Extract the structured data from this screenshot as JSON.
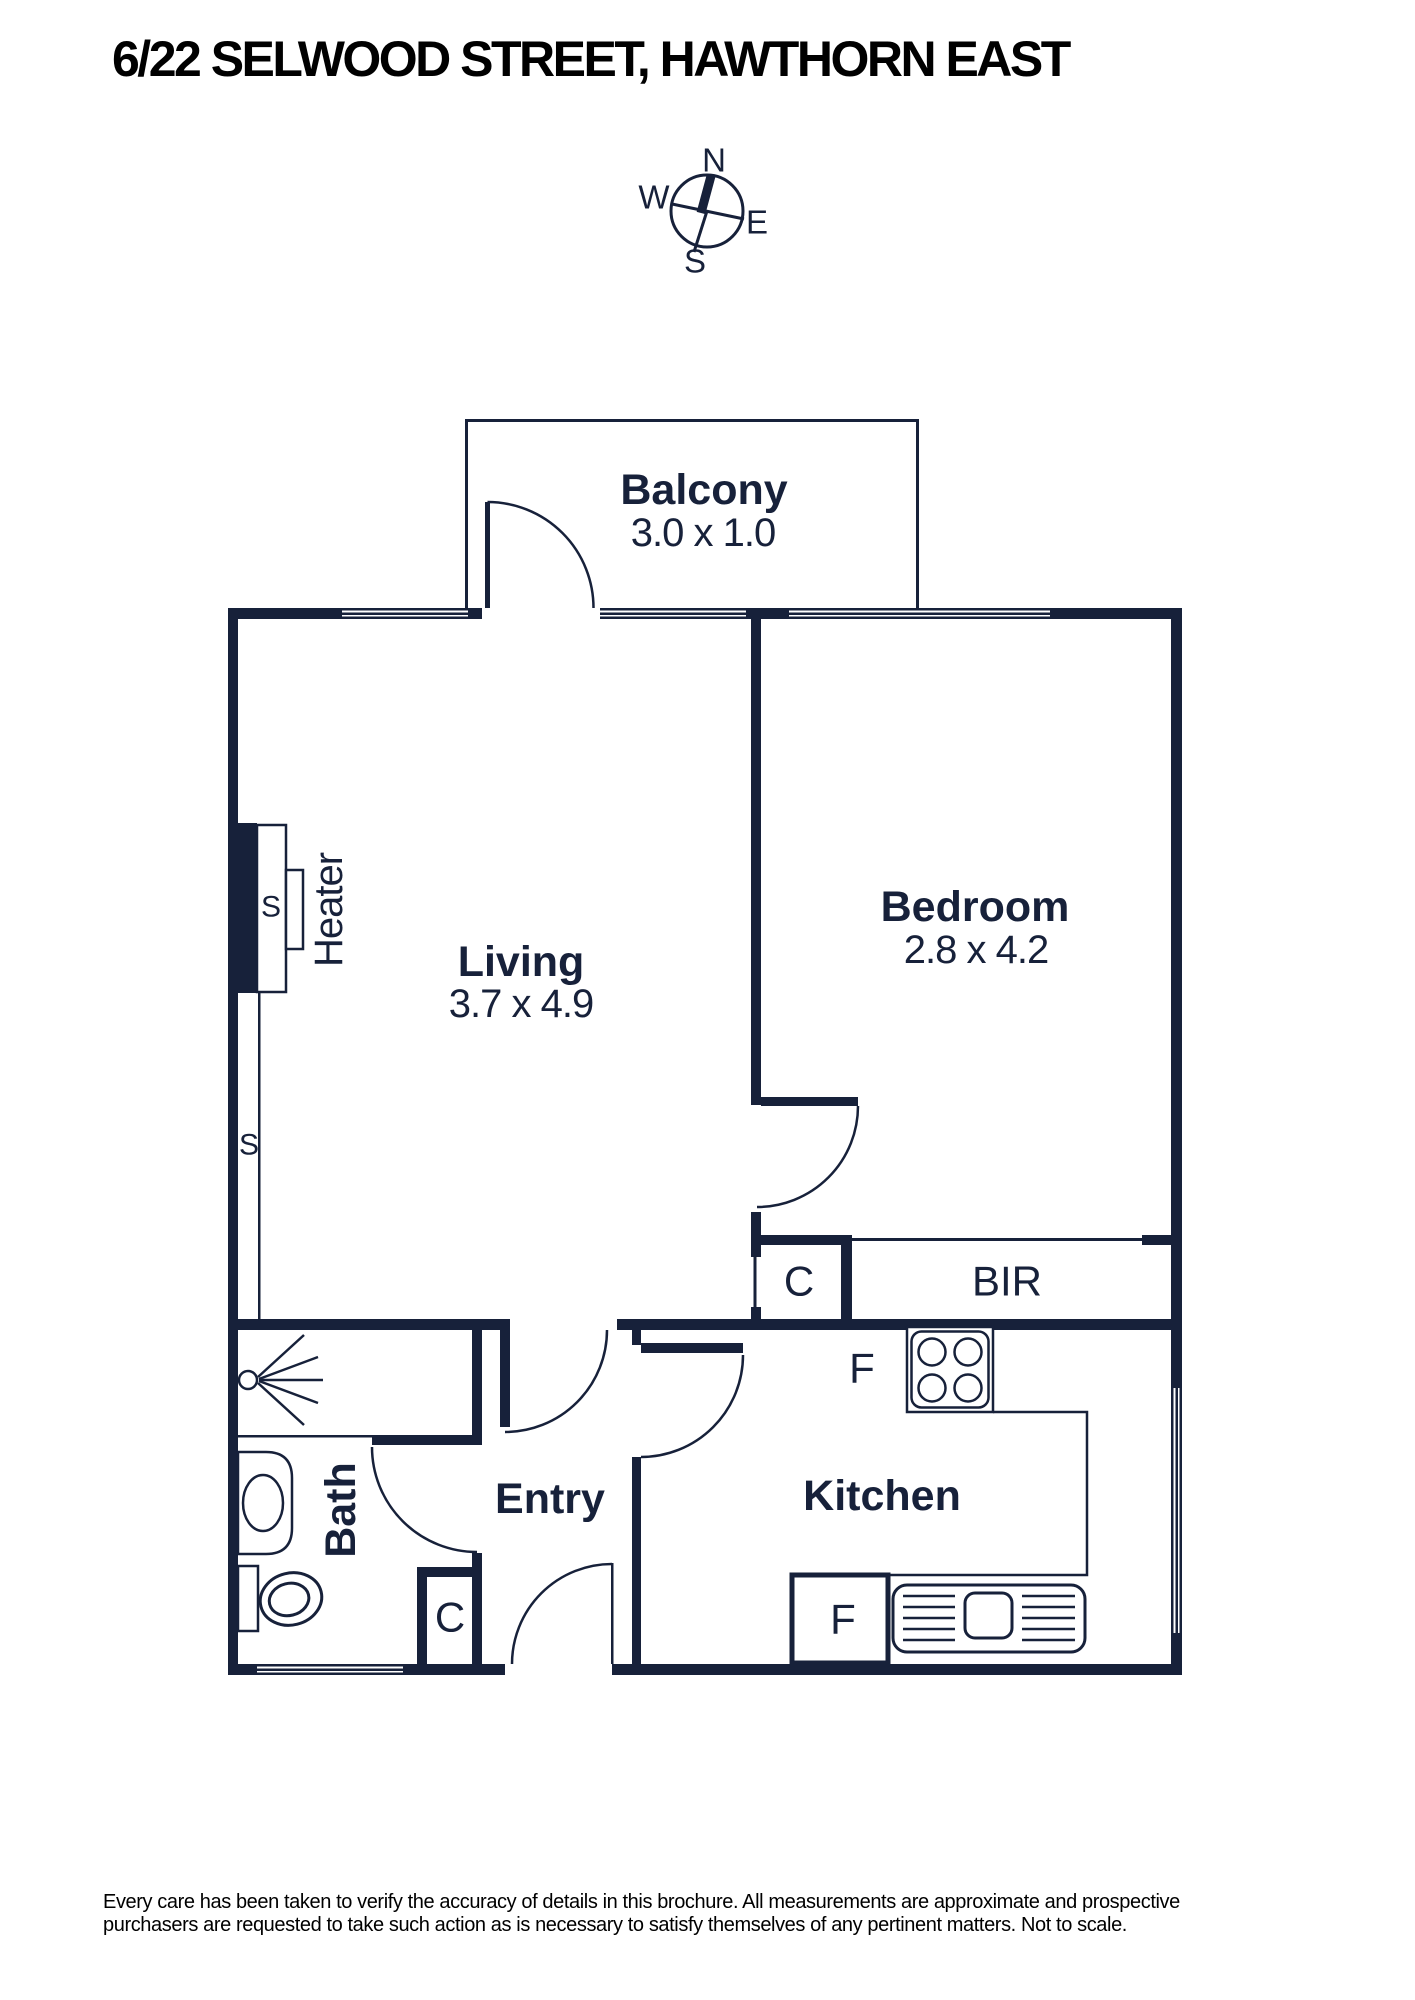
{
  "header": {
    "title": "6/22 SELWOOD STREET, HAWTHORN EAST"
  },
  "compass": {
    "n": "N",
    "s": "S",
    "e": "E",
    "w": "W"
  },
  "rooms": {
    "balcony": {
      "name": "Balcony",
      "dims": "3.0 x 1.0"
    },
    "living": {
      "name": "Living",
      "dims": "3.7 x 4.9"
    },
    "bedroom": {
      "name": "Bedroom",
      "dims": "2.8 x 4.2"
    },
    "kitchen": {
      "name": "Kitchen"
    },
    "entry": {
      "name": "Entry"
    },
    "bath": {
      "name": "Bath"
    }
  },
  "fixtures": {
    "heater": "Heater",
    "bir": "BIR",
    "cupboard_hall": "C",
    "cupboard_entry": "C",
    "fridge_upper": "F",
    "fridge_lower": "F",
    "switch_heater": "S",
    "switch_wall": "S"
  },
  "footer": {
    "disclaimer": [
      "Every care has been taken to verify the accuracy of details in this brochure. All measurements are approximate and prospective",
      "purchasers are requested to take such action as is necessary to satisfy themselves of any pertinent matters. Not to scale."
    ]
  },
  "colors": {
    "ink": "#17213a",
    "text": "#000000"
  }
}
